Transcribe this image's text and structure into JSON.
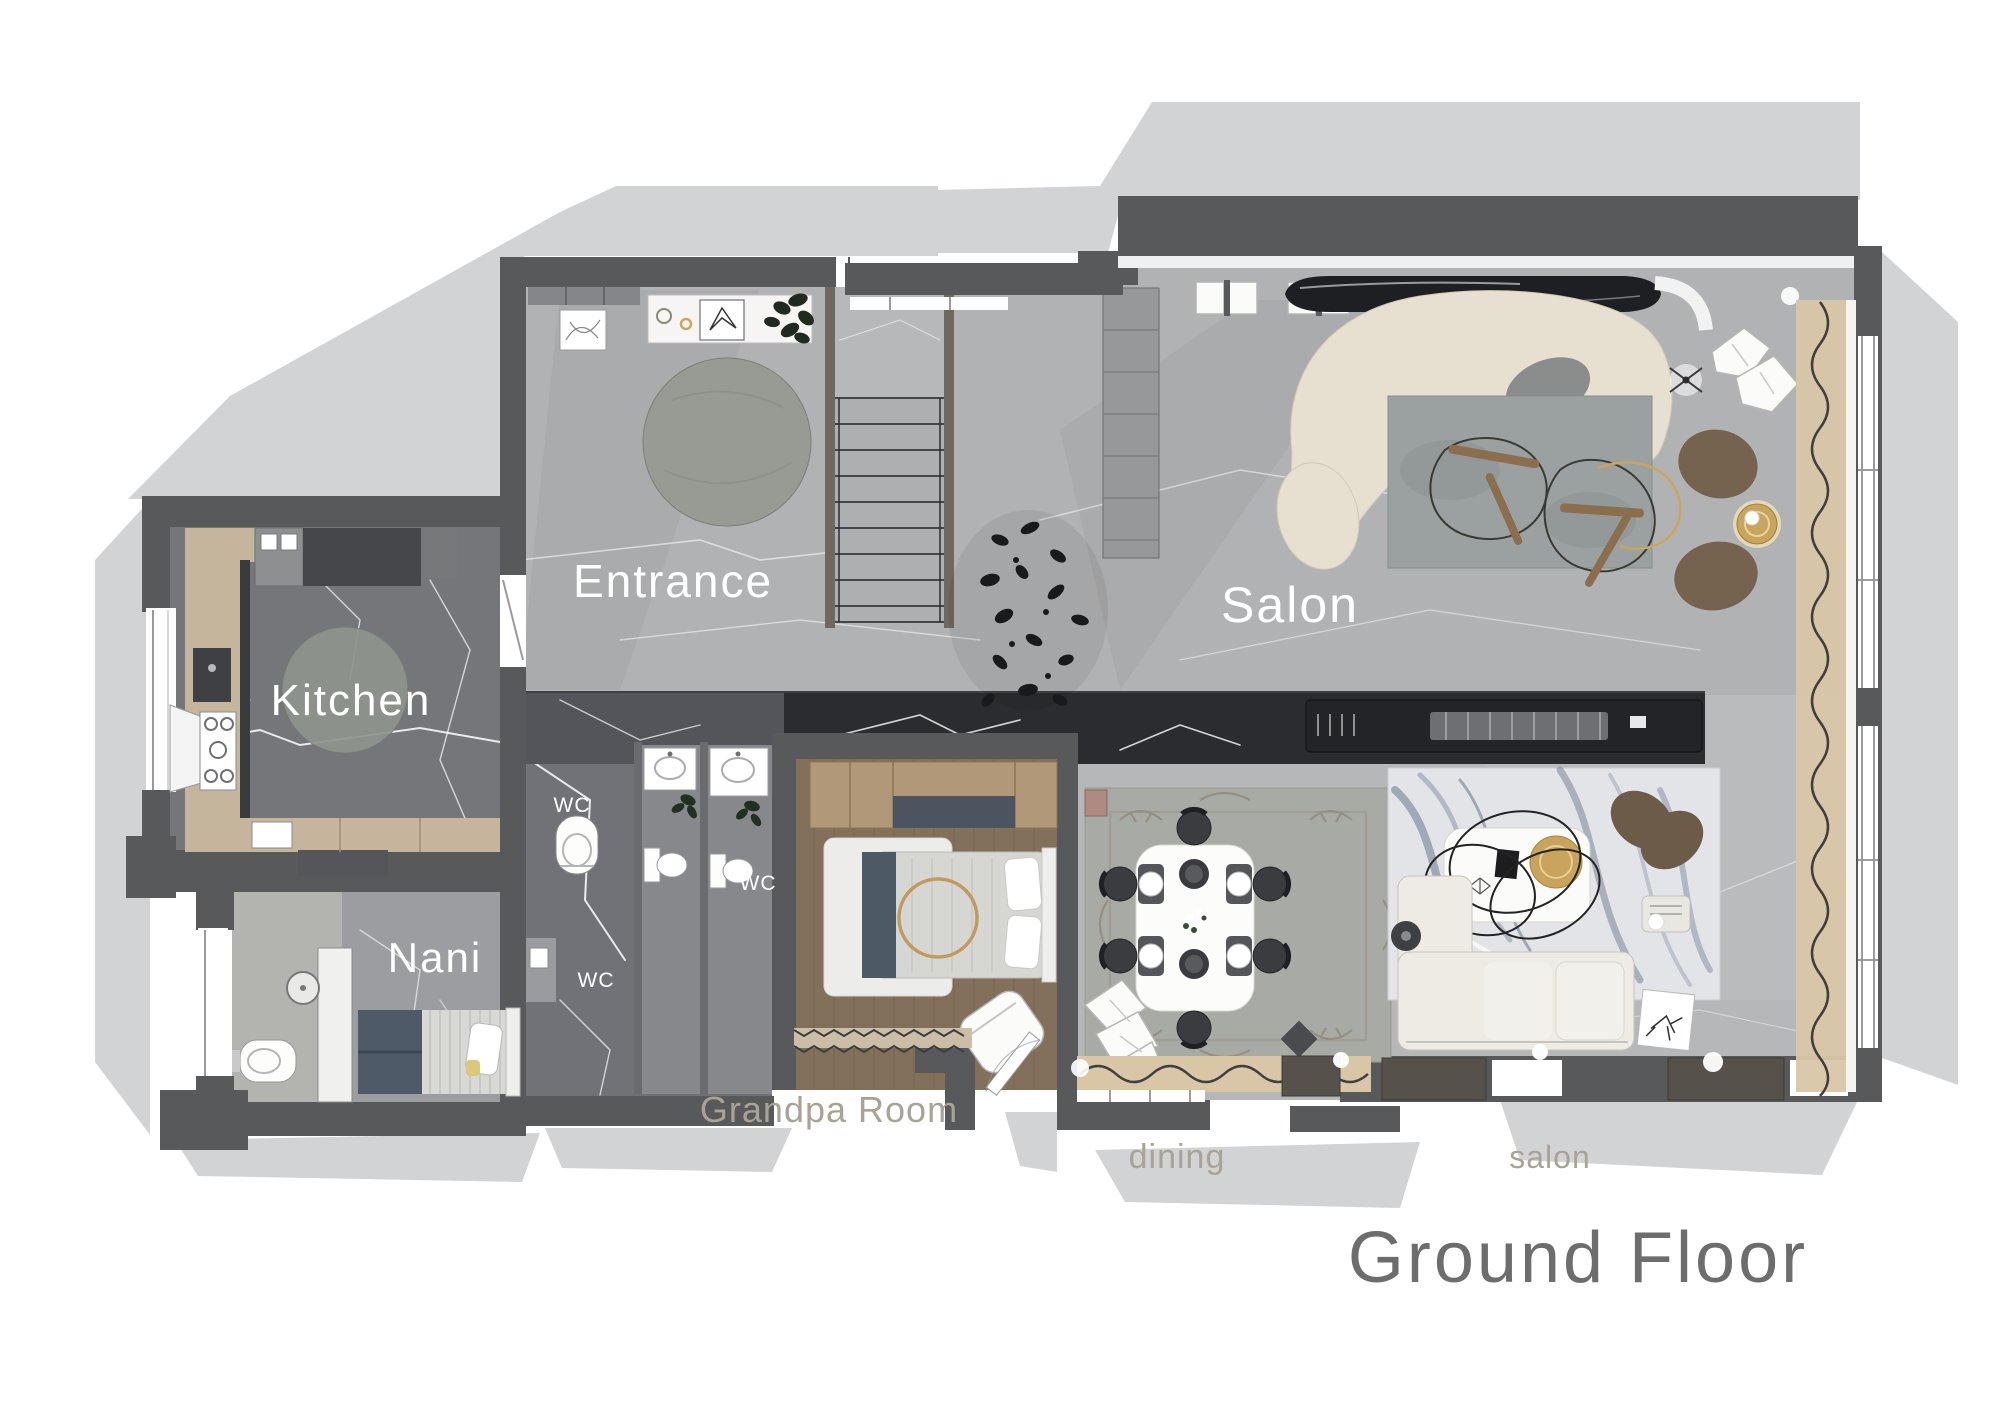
{
  "document": {
    "kind": "interior-design floor plan rendering",
    "floor": "ground"
  },
  "labels": {
    "entrance": "Entrance",
    "salon": "Salon",
    "kitchen": "Kitchen",
    "nani": "Nani",
    "wc_corridor": "WC",
    "wc_bathroom": "WC",
    "wc_lower": "WC",
    "grandpa_room": "Grandpa Room",
    "dining": "dining",
    "salon_seating": "salon",
    "title": "Ground Floor"
  },
  "palette": {
    "background": "#ffffff",
    "wall": "#58595b",
    "shadow": "#d2d3d5",
    "floor_light_marble": "#b1b2b4",
    "floor_dark_marble": "#75767a",
    "floor_black_marble": "#2b2c2f",
    "wood_floor": "#82705b",
    "wardrobe_wood": "#b19878",
    "counter_wood": "#c5b59c",
    "cream_sofa": "#e7e0d1",
    "gray_rug": "#9ba1a1",
    "marble_rug_streak": "#76809a",
    "curtain_beige": "#d9c6a6",
    "gold_accent": "#c8a45c",
    "navy_accent": "#4e5966",
    "pouf_brown": "#6d5b49",
    "label_white": "#ffffff",
    "label_tan": "#a9a395",
    "title_gray": "#6d6d6d"
  }
}
